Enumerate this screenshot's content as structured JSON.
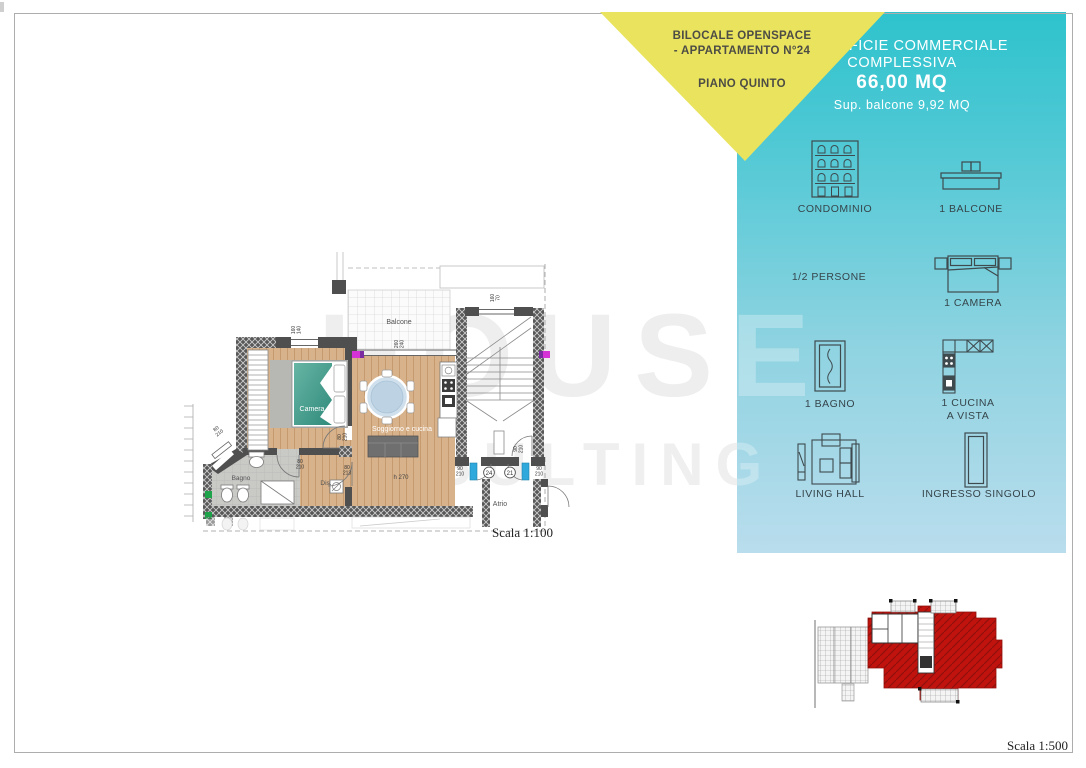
{
  "banner": {
    "line1": "BILOCALE OPENSPACE",
    "line2": "- APPARTAMENTO N°24",
    "line3": "PIANO QUINTO"
  },
  "summary": {
    "title_line1": "SUPERFICIE COMMERCIALE",
    "title_line2": "COMPLESSIVA",
    "area": "66,00 MQ",
    "balcony_note": "Sup. balcone 9,92  MQ"
  },
  "features": {
    "condominio": "CONDOMINIO",
    "balcone": "1 BALCONE",
    "persone": "1/2 PERSONE",
    "camera": "1 CAMERA",
    "bagno": "1 BAGNO",
    "cucina_line1": "1 CUCINA",
    "cucina_line2": "A VISTA",
    "living_hall": "LIVING HALL",
    "ingresso": "INGRESSO SINGOLO"
  },
  "watermark": {
    "line1": "HOUSE",
    "line2": "CONSULTING"
  },
  "plan": {
    "rooms": {
      "balcone": "Balcone",
      "camera": "Camera",
      "bagno": "Bagno",
      "dis": "Dis.",
      "soggiorno": "Soggiorno e cucina",
      "atrio": "Atrio",
      "height": "h 270"
    },
    "apartments": {
      "n24": "24",
      "n21": "21"
    },
    "dims": {
      "n160": "160",
      "n140": "140",
      "n260": "260",
      "n240": "240",
      "n70": "70",
      "n90": "90",
      "n210": "210",
      "n80": "80",
      "n213": "213"
    },
    "scale": "Scala 1:100"
  },
  "siteplan": {
    "scale": "Scala 1:500"
  },
  "colors": {
    "teal_top": "#2ec3cd",
    "teal_bottom": "#b9dded",
    "yellow": "#e9e35e",
    "site_red": "#c0130e",
    "door_blue": "#2fa8dc",
    "bed_teal": "#3f9d8d",
    "wood": "#d8b28a"
  }
}
